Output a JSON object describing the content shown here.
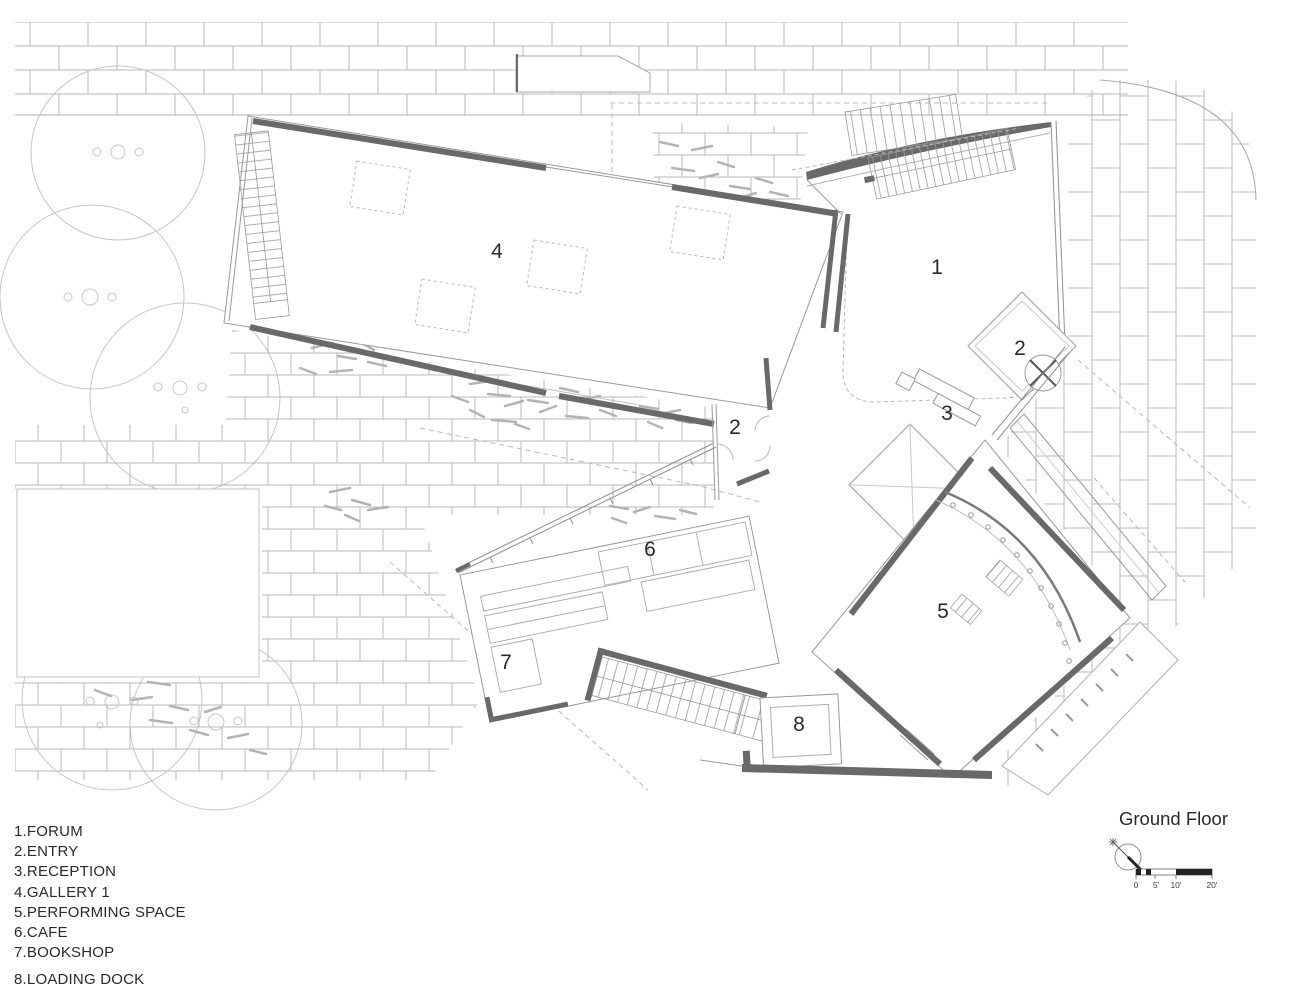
{
  "title": "Ground Floor",
  "legend": {
    "items": [
      {
        "number": "1",
        "name": "FORUM",
        "text": "1.FORUM"
      },
      {
        "number": "2",
        "name": "ENTRY",
        "text": "2.ENTRY"
      },
      {
        "number": "3",
        "name": "RECEPTION",
        "text": "3.RECEPTION"
      },
      {
        "number": "4",
        "name": "GALLERY 1",
        "text": "4.GALLERY 1"
      },
      {
        "number": "5",
        "name": "PERFORMING SPACE",
        "text": "5.PERFORMING SPACE"
      },
      {
        "number": "6",
        "name": "CAFE",
        "text": "6.CAFE"
      },
      {
        "number": "7",
        "name": "BOOKSHOP",
        "text": "7.BOOKSHOP"
      },
      {
        "number": "8",
        "name": "LOADING DOCK",
        "text": "8.LOADING DOCK"
      }
    ]
  },
  "plan": {
    "labels": [
      "4",
      "1",
      "2",
      "3",
      "2",
      "6",
      "5",
      "7",
      "8"
    ]
  },
  "scale_bar": {
    "ticks": [
      "0",
      "5'",
      "10'",
      "20'"
    ]
  },
  "north": {
    "icon": "north-arrow"
  },
  "colors": {
    "ink": "#2a2a2a",
    "wall": "#696969",
    "line": "#9a9a9a",
    "faint": "#bcbcbc"
  }
}
